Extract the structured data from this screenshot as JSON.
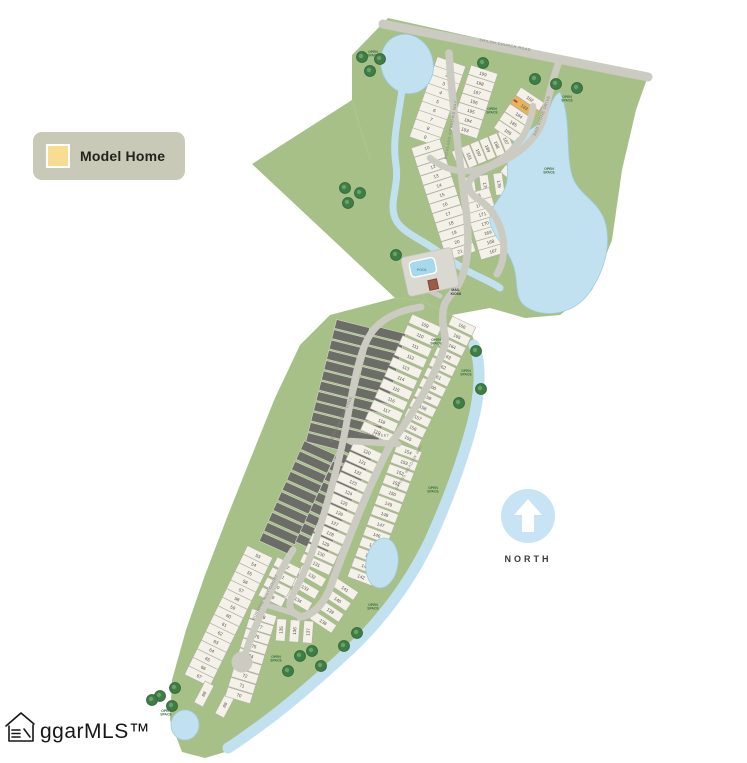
{
  "window": {
    "width": 747,
    "height": 763
  },
  "legend": {
    "model_home_label": "Model Home",
    "swatch_color": "#f8dc92"
  },
  "compass": {
    "label": "NORTH",
    "circle_color": "#c8e4f4"
  },
  "watermark": {
    "text": "ggarMLS™"
  },
  "colors": {
    "green": "#a6c087",
    "water": "#c2e1f0",
    "water_edge": "#9ecbe0",
    "road": "#cbcbc2",
    "lot_fill": "#f3f1e8",
    "lot_stroke": "#b2b0a4",
    "lot_dark": "#6b6d66",
    "lot_dark_stroke": "#d6d6cd",
    "lot_number": "#55534c",
    "model": "#e9b35a",
    "model_marker": "#c0392b",
    "open_space_text": "#3c7040",
    "road_label_text": "#84847a",
    "tree_outer": "#3f7d44",
    "tree_inner": "#68a26b",
    "pool_fill": "#a8d8ec",
    "building_fill": "#9c5a48"
  },
  "map": {
    "model_home_lot": "183",
    "open_space": {
      "line1": "OPEN",
      "line2": "SPACE",
      "positions": [
        [
          373,
          53
        ],
        [
          492,
          110
        ],
        [
          567,
          98
        ],
        [
          549,
          170
        ],
        [
          436,
          341
        ],
        [
          466,
          372
        ],
        [
          433,
          489
        ],
        [
          373,
          606
        ],
        [
          276,
          658
        ],
        [
          166,
          712
        ]
      ]
    },
    "tree_positions": [
      [
        362,
        57
      ],
      [
        380,
        59
      ],
      [
        370,
        71
      ],
      [
        483,
        63
      ],
      [
        535,
        79
      ],
      [
        556,
        84
      ],
      [
        577,
        88
      ],
      [
        345,
        188
      ],
      [
        360,
        193
      ],
      [
        348,
        203
      ],
      [
        396,
        255
      ],
      [
        476,
        351
      ],
      [
        481,
        389
      ],
      [
        459,
        403
      ],
      [
        357,
        633
      ],
      [
        344,
        646
      ],
      [
        312,
        651
      ],
      [
        300,
        656
      ],
      [
        321,
        666
      ],
      [
        288,
        671
      ],
      [
        175,
        688
      ],
      [
        160,
        696
      ],
      [
        172,
        706
      ],
      [
        152,
        700
      ]
    ],
    "road_labels": [
      {
        "text": "SHILOH CHURCH ROAD"
      },
      {
        "text": "RICHLAND MEADOWS WAY"
      },
      {
        "text": "RED STONE DRIVE"
      },
      {
        "text": "SPRING MEADOW WAY"
      },
      {
        "text": "MEADOWBROOK COVE"
      },
      {
        "text": "MAIN STREET"
      },
      {
        "text": "MORNING MIST COURT"
      }
    ],
    "amenities": {
      "pool_label": "POOL",
      "kiosk_label_1": "MAIL",
      "kiosk_label_2": "KIOSK"
    },
    "lot_groups": [
      {
        "name": "lots-1-9",
        "numbers": [
          1,
          2,
          3,
          4,
          5,
          6,
          7,
          8,
          9
        ],
        "start": [
          450,
          66
        ],
        "step": [
          -3.1,
          8.9
        ],
        "size": [
          30,
          9.5
        ]
      },
      {
        "name": "lots-10-21",
        "numbers": [
          10,
          11,
          12,
          13,
          14,
          15,
          16,
          17,
          18,
          19,
          20,
          21
        ],
        "start": [
          427,
          148
        ],
        "step": [
          3.0,
          9.4
        ],
        "size": [
          30,
          9.5
        ]
      },
      {
        "name": "lots-199-193",
        "numbers": [
          199,
          198,
          197,
          196,
          195,
          194,
          193
        ],
        "start": [
          483,
          74
        ],
        "step": [
          -3.0,
          9.3
        ],
        "size": [
          28,
          9.5
        ]
      },
      {
        "name": "lots-192-187",
        "numbers": [
          192,
          191,
          190,
          189,
          188,
          187
        ],
        "start": [
          460,
          160
        ],
        "step": [
          9.2,
          -3.8
        ],
        "size": [
          22,
          9
        ]
      },
      {
        "name": "lots-182-186",
        "numbers": [
          182,
          183,
          184,
          185,
          186
        ],
        "start": [
          530,
          99
        ],
        "step": [
          -5.5,
          8.2
        ],
        "size": [
          28,
          9.5
        ]
      },
      {
        "name": "lots-181-177",
        "numbers": [
          181,
          180,
          179,
          178,
          177
        ],
        "start": [
          538,
          147
        ],
        "step": [
          -6.0,
          7.5
        ],
        "size": [
          28,
          9.5
        ]
      },
      {
        "name": "lots-174-176",
        "numbers": [
          174,
          175,
          176
        ],
        "start": [
          471,
          188
        ],
        "step": [
          14,
          -2
        ],
        "size": [
          22,
          9
        ]
      },
      {
        "name": "lots-173-167",
        "numbers": [
          173,
          172,
          171,
          170,
          169,
          168,
          167
        ],
        "start": [
          477,
          196
        ],
        "step": [
          2.7,
          9.2
        ],
        "size": [
          28,
          9.5
        ]
      },
      {
        "name": "future-lots-a",
        "type": "dark",
        "count": 12,
        "start": [
          352,
          328
        ],
        "step": [
          -2.6,
          10.3
        ],
        "size": [
          34,
          9
        ]
      },
      {
        "name": "future-lots-b",
        "type": "dark",
        "count": 10,
        "start": [
          318,
          452
        ],
        "step": [
          -4.6,
          10.2
        ],
        "size": [
          34,
          9
        ]
      },
      {
        "name": "future-lots-c",
        "type": "dark",
        "count": 11,
        "start": [
          388,
          334
        ],
        "step": [
          -2.6,
          10.3
        ],
        "size": [
          34,
          9
        ]
      },
      {
        "name": "future-lots-d",
        "type": "dark",
        "count": 10,
        "start": [
          356,
          452
        ],
        "step": [
          -4.8,
          10.3
        ],
        "size": [
          34,
          9
        ]
      },
      {
        "name": "lots-109-119",
        "numbers": [
          109,
          110,
          111,
          112,
          113,
          114,
          115,
          116,
          117,
          118,
          119
        ],
        "start": [
          425,
          325
        ],
        "step": [
          -4.8,
          10.7
        ],
        "size": [
          32,
          9.5
        ]
      },
      {
        "name": "lots-166-155",
        "numbers": [
          166,
          165,
          164,
          163,
          162,
          161,
          160,
          159,
          158,
          157,
          156,
          155
        ],
        "start": [
          462,
          326
        ],
        "step": [
          -4.9,
          10.2
        ],
        "size": [
          26,
          9.5
        ]
      },
      {
        "name": "lots-154-142",
        "numbers": [
          154,
          153,
          152,
          151,
          150,
          149,
          148,
          147,
          146,
          145,
          144,
          143,
          142
        ],
        "start": [
          408,
          452
        ],
        "step": [
          -3.9,
          10.4
        ],
        "size": [
          26,
          9.5
        ]
      },
      {
        "name": "lots-141-138",
        "numbers": [
          141,
          140,
          139,
          138
        ],
        "start": [
          345,
          589
        ],
        "step": [
          -7.3,
          11
        ],
        "size": [
          26,
          9.5
        ]
      },
      {
        "name": "lots-120-131",
        "numbers": [
          120,
          121,
          122,
          123,
          124,
          125,
          126,
          127,
          128,
          129,
          130,
          131
        ],
        "start": [
          367,
          452
        ],
        "step": [
          -4.6,
          10.2
        ],
        "size": [
          32,
          9.5
        ]
      },
      {
        "name": "lots-132-134",
        "numbers": [
          132,
          133,
          134
        ],
        "start": [
          312,
          576
        ],
        "step": [
          -7,
          12
        ],
        "size": [
          28,
          9.5
        ]
      },
      {
        "name": "lots-135-137",
        "numbers": [
          135,
          136,
          137
        ],
        "start": [
          281,
          630
        ],
        "step": [
          13.5,
          1
        ],
        "size": [
          22,
          9.5
        ]
      },
      {
        "name": "lots-53-67",
        "numbers": [
          53,
          54,
          55,
          56,
          57,
          58,
          59,
          60,
          61,
          62,
          63,
          64,
          65,
          66,
          67
        ],
        "start": [
          258,
          556
        ],
        "step": [
          -4.2,
          8.6
        ],
        "size": [
          28,
          9.5
        ]
      },
      {
        "name": "lots-68-69",
        "numbers": [
          68,
          69
        ],
        "start": [
          204,
          694
        ],
        "step": [
          21,
          11
        ],
        "size": [
          24,
          10
        ]
      },
      {
        "name": "lots-82-79",
        "numbers": [
          82,
          81,
          80,
          79
        ],
        "start": [
          287,
          567
        ],
        "step": [
          -5,
          10
        ],
        "size": [
          26,
          9.5
        ]
      },
      {
        "name": "lots-78-70",
        "numbers": [
          78,
          77,
          76,
          75,
          74,
          73,
          72,
          71,
          70
        ],
        "start": [
          263,
          617
        ],
        "step": [
          -3.0,
          9.8
        ],
        "size": [
          26,
          9.5
        ]
      }
    ]
  }
}
